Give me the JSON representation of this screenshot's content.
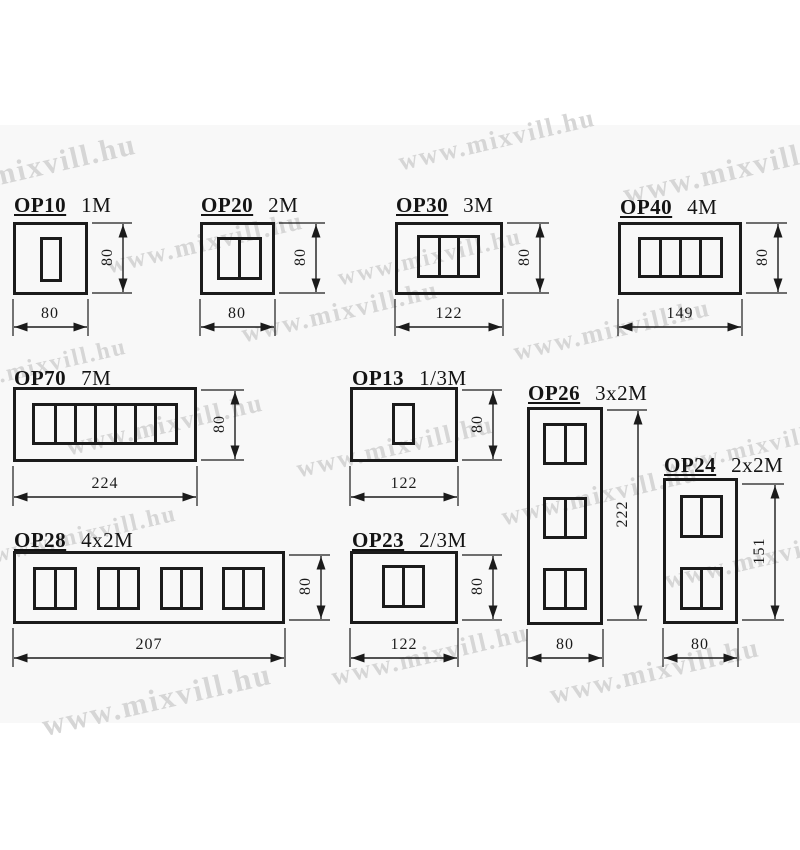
{
  "page": {
    "background": "#ffffff",
    "band_color": "#f8f8f8",
    "line_color": "#1b1b1b",
    "text_color": "#141414"
  },
  "watermark": {
    "text": "www.mixvill.hu",
    "color": "#d6d6d6",
    "angle_deg": -13,
    "positions": [
      {
        "x": 497,
        "y": 140,
        "s": 26
      },
      {
        "x": 735,
        "y": 170,
        "s": 30
      },
      {
        "x": 25,
        "y": 170,
        "s": 30
      },
      {
        "x": 205,
        "y": 243,
        "s": 26
      },
      {
        "x": 430,
        "y": 258,
        "s": 24
      },
      {
        "x": 340,
        "y": 312,
        "s": 26
      },
      {
        "x": 612,
        "y": 330,
        "s": 26
      },
      {
        "x": 35,
        "y": 368,
        "s": 24
      },
      {
        "x": 165,
        "y": 425,
        "s": 26
      },
      {
        "x": 395,
        "y": 447,
        "s": 26
      },
      {
        "x": 755,
        "y": 448,
        "s": 24
      },
      {
        "x": 600,
        "y": 495,
        "s": 26
      },
      {
        "x": 85,
        "y": 535,
        "s": 24
      },
      {
        "x": 763,
        "y": 558,
        "s": 26
      },
      {
        "x": 430,
        "y": 655,
        "s": 26
      },
      {
        "x": 655,
        "y": 672,
        "s": 28
      },
      {
        "x": 157,
        "y": 700,
        "s": 31
      }
    ]
  },
  "products": [
    {
      "code": "OP10",
      "size": "1M",
      "label": {
        "x": 14,
        "y": 193
      },
      "box": {
        "x": 13,
        "y": 222,
        "w": 75,
        "h": 73
      },
      "windows": [
        {
          "x": 27,
          "y": 15,
          "w": 22,
          "h": 45,
          "cols": 1
        }
      ],
      "dim_w": {
        "value": "80",
        "x1": 13,
        "x2": 88,
        "y": 327,
        "tx": 50,
        "ty": 305
      },
      "dim_h": {
        "value": "80",
        "x": 123,
        "y1": 223,
        "y2": 293,
        "tx": 108,
        "ty": 258
      }
    },
    {
      "code": "OP20",
      "size": "2M",
      "label": {
        "x": 201,
        "y": 193
      },
      "box": {
        "x": 200,
        "y": 222,
        "w": 75,
        "h": 73
      },
      "windows": [
        {
          "x": 17,
          "y": 15,
          "w": 45,
          "h": 43,
          "cols": 2
        }
      ],
      "dim_w": {
        "value": "80",
        "x1": 200,
        "x2": 275,
        "y": 327,
        "tx": 237,
        "ty": 305
      },
      "dim_h": {
        "value": "80",
        "x": 316,
        "y1": 223,
        "y2": 293,
        "tx": 301,
        "ty": 258
      }
    },
    {
      "code": "OP30",
      "size": "3M",
      "label": {
        "x": 396,
        "y": 193
      },
      "box": {
        "x": 395,
        "y": 222,
        "w": 108,
        "h": 73
      },
      "windows": [
        {
          "x": 22,
          "y": 13,
          "w": 63,
          "h": 43,
          "cols": 3
        }
      ],
      "dim_w": {
        "value": "122",
        "x1": 395,
        "x2": 503,
        "y": 327,
        "tx": 449,
        "ty": 305
      },
      "dim_h": {
        "value": "80",
        "x": 540,
        "y1": 223,
        "y2": 293,
        "tx": 525,
        "ty": 258
      }
    },
    {
      "code": "OP40",
      "size": "4M",
      "label": {
        "x": 620,
        "y": 195
      },
      "box": {
        "x": 618,
        "y": 222,
        "w": 124,
        "h": 73
      },
      "windows": [
        {
          "x": 20,
          "y": 15,
          "w": 85,
          "h": 41,
          "cols": 4
        }
      ],
      "dim_w": {
        "value": "149",
        "x1": 618,
        "x2": 742,
        "y": 327,
        "tx": 680,
        "ty": 305
      },
      "dim_h": {
        "value": "80",
        "x": 778,
        "y1": 223,
        "y2": 293,
        "tx": 763,
        "ty": 258
      }
    },
    {
      "code": "OP70",
      "size": "7M",
      "label": {
        "x": 14,
        "y": 366
      },
      "box": {
        "x": 13,
        "y": 387,
        "w": 184,
        "h": 75
      },
      "windows": [
        {
          "x": 19,
          "y": 16,
          "w": 146,
          "h": 42,
          "cols": 7
        }
      ],
      "dim_w": {
        "value": "224",
        "x1": 13,
        "x2": 197,
        "y": 497,
        "tx": 105,
        "ty": 475
      },
      "dim_h": {
        "value": "80",
        "x": 235,
        "y1": 390,
        "y2": 460,
        "tx": 220,
        "ty": 425
      }
    },
    {
      "code": "OP13",
      "size": "1/3M",
      "label": {
        "x": 352,
        "y": 366
      },
      "box": {
        "x": 350,
        "y": 387,
        "w": 108,
        "h": 75
      },
      "windows": [
        {
          "x": 42,
          "y": 16,
          "w": 23,
          "h": 42,
          "cols": 1
        }
      ],
      "dim_w": {
        "value": "122",
        "x1": 350,
        "x2": 458,
        "y": 497,
        "tx": 404,
        "ty": 475
      },
      "dim_h": {
        "value": "80",
        "x": 493,
        "y1": 390,
        "y2": 460,
        "tx": 478,
        "ty": 425
      }
    },
    {
      "code": "OP26",
      "size": "3x2M",
      "label": {
        "x": 528,
        "y": 381
      },
      "box": {
        "x": 527,
        "y": 407,
        "w": 76,
        "h": 218
      },
      "windows": [
        {
          "x": 16,
          "y": 16,
          "w": 44,
          "h": 42,
          "cols": 2
        },
        {
          "x": 16,
          "y": 90,
          "w": 44,
          "h": 42,
          "cols": 2
        },
        {
          "x": 16,
          "y": 161,
          "w": 44,
          "h": 42,
          "cols": 2
        }
      ],
      "dim_w": {
        "value": "80",
        "x1": 527,
        "x2": 603,
        "y": 658,
        "tx": 565,
        "ty": 636
      },
      "dim_h": {
        "value": "222",
        "x": 638,
        "y1": 410,
        "y2": 620,
        "tx": 623,
        "ty": 515
      }
    },
    {
      "code": "OP24",
      "size": "2x2M",
      "label": {
        "x": 664,
        "y": 453
      },
      "box": {
        "x": 663,
        "y": 478,
        "w": 75,
        "h": 146
      },
      "windows": [
        {
          "x": 17,
          "y": 17,
          "w": 43,
          "h": 43,
          "cols": 2
        },
        {
          "x": 17,
          "y": 89,
          "w": 43,
          "h": 43,
          "cols": 2
        }
      ],
      "dim_w": {
        "value": "80",
        "x1": 663,
        "x2": 738,
        "y": 658,
        "tx": 700,
        "ty": 636
      },
      "dim_h": {
        "value": "151",
        "x": 775,
        "y1": 484,
        "y2": 620,
        "tx": 760,
        "ty": 552
      }
    },
    {
      "code": "OP28",
      "size": "4x2M",
      "label": {
        "x": 14,
        "y": 528
      },
      "box": {
        "x": 13,
        "y": 551,
        "w": 272,
        "h": 73
      },
      "windows": [
        {
          "x": 20,
          "y": 16,
          "w": 44,
          "h": 43,
          "cols": 2
        },
        {
          "x": 84,
          "y": 16,
          "w": 43,
          "h": 43,
          "cols": 2
        },
        {
          "x": 147,
          "y": 16,
          "w": 43,
          "h": 43,
          "cols": 2
        },
        {
          "x": 209,
          "y": 16,
          "w": 43,
          "h": 43,
          "cols": 2
        }
      ],
      "dim_w": {
        "value": "207",
        "x1": 13,
        "x2": 285,
        "y": 658,
        "tx": 149,
        "ty": 636
      },
      "dim_h": {
        "value": "80",
        "x": 321,
        "y1": 555,
        "y2": 620,
        "tx": 306,
        "ty": 587
      }
    },
    {
      "code": "OP23",
      "size": "2/3M",
      "label": {
        "x": 352,
        "y": 528
      },
      "box": {
        "x": 350,
        "y": 551,
        "w": 108,
        "h": 73
      },
      "windows": [
        {
          "x": 32,
          "y": 14,
          "w": 43,
          "h": 43,
          "cols": 2
        }
      ],
      "dim_w": {
        "value": "122",
        "x1": 350,
        "x2": 458,
        "y": 658,
        "tx": 404,
        "ty": 636
      },
      "dim_h": {
        "value": "80",
        "x": 493,
        "y1": 555,
        "y2": 620,
        "tx": 478,
        "ty": 587
      }
    }
  ]
}
